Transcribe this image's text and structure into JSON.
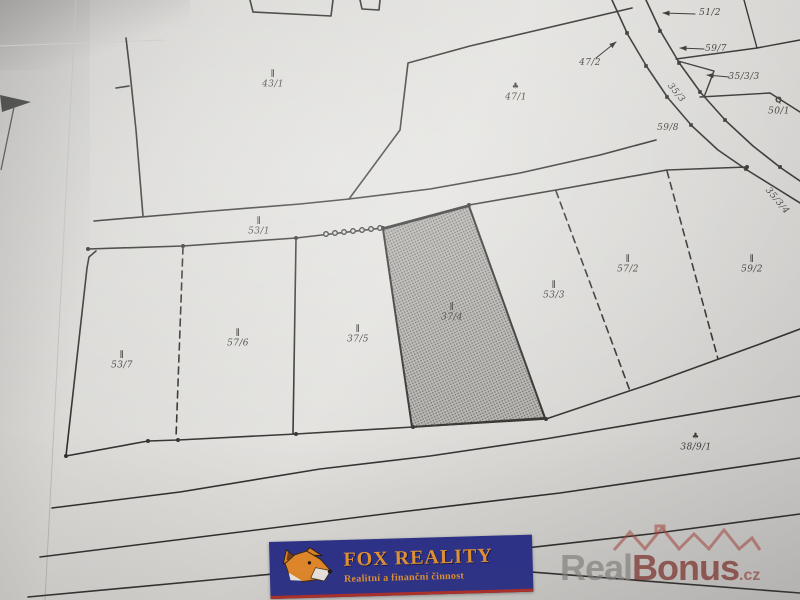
{
  "labels": {
    "p43_1": {
      "symbol": "∥",
      "text": "43/1"
    },
    "p47_1": {
      "symbol": "♣",
      "text": "47/1"
    },
    "p53_1": {
      "symbol": "∥",
      "text": "53/1"
    },
    "p53_7": {
      "symbol": "∥",
      "text": "53/7"
    },
    "p57_6": {
      "symbol": "∥",
      "text": "57/6"
    },
    "p37_5": {
      "symbol": "∥",
      "text": "37/5"
    },
    "p37_4": {
      "symbol": "∥",
      "text": "37/4"
    },
    "p53_3": {
      "symbol": "∥",
      "text": "53/3"
    },
    "p57_2": {
      "symbol": "∥",
      "text": "57/2"
    },
    "p59_2": {
      "symbol": "∥",
      "text": "59/2"
    },
    "p38_9_1": {
      "symbol": "♣",
      "text": "38/9/1"
    },
    "p50_1": {
      "symbol": "Q",
      "text": "50/1"
    },
    "p59_8": {
      "text": "59/8"
    },
    "p59_7": {
      "text": "59/7"
    },
    "p51_2": {
      "text": "51/2"
    },
    "p35_3_3": {
      "text": "35/3/3"
    },
    "p47_2": {
      "text": "47/2"
    },
    "road_35_3": {
      "text": "35/3"
    },
    "road_35_3_4": {
      "text": "35/3/4"
    }
  },
  "highlighted_parcel": "37/4",
  "logo": {
    "title": "FOX REALITY",
    "subtitle": "Realitní a finanční činnost",
    "bg_color": "#2a2f8d",
    "text_color": "#ef9730"
  },
  "watermark": {
    "part1": "Real",
    "part2": "Bonus",
    "part3": ".cz",
    "gray": "#868582",
    "red": "#7c241d"
  },
  "colors": {
    "map_line": "#2e2d2b",
    "paper": "#dcdbd8",
    "shaded_parcel": "#a9a8a4"
  }
}
